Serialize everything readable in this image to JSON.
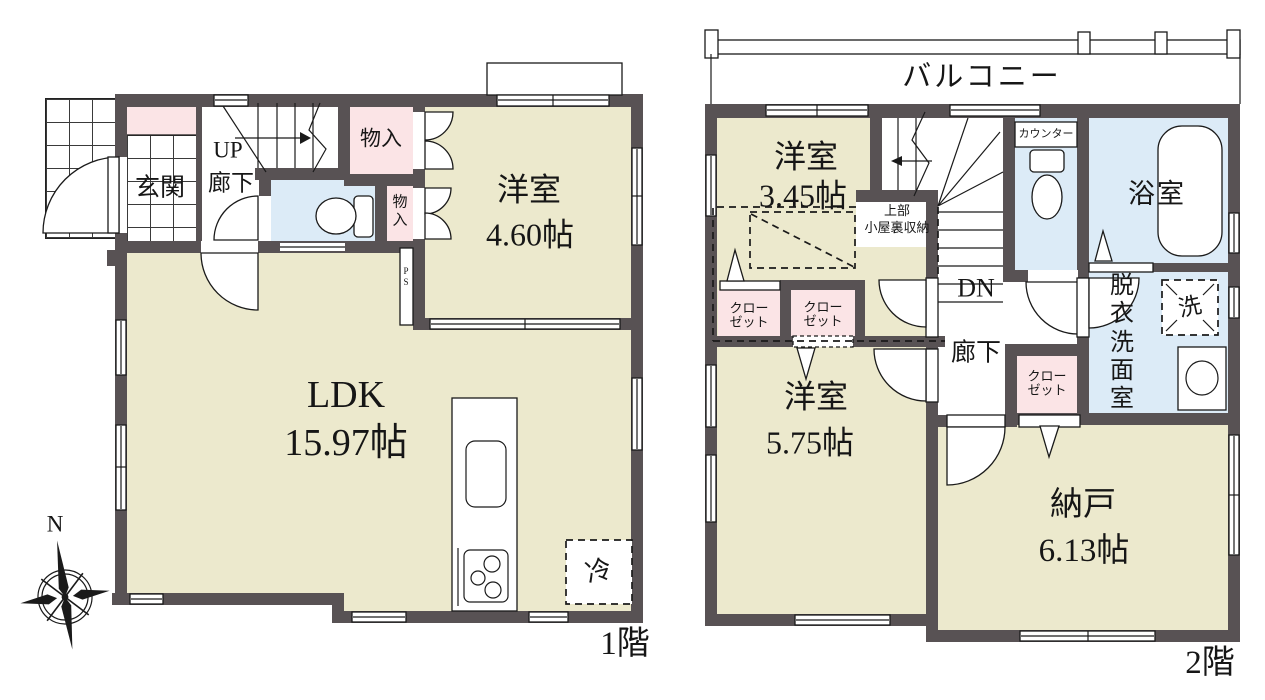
{
  "floor1": {
    "floor_label": "1階",
    "compass_north": "N",
    "entrance": "玄関",
    "stairs_up": "UP",
    "hallway": "廊下",
    "storage_upper": "物入",
    "storage_lower": "物入",
    "western_room": {
      "name": "洋室",
      "size": "4.60帖"
    },
    "ldk": {
      "name": "LDK",
      "size": "15.97帖"
    },
    "refrigerator": "冷",
    "pipe_space": "PS"
  },
  "floor2": {
    "floor_label": "2階",
    "balcony": "バルコニー",
    "western_room_small": {
      "name": "洋室",
      "size": "3.45帖"
    },
    "attic_storage": {
      "line1": "上部",
      "line2": "小屋裏収納"
    },
    "counter": "カウンター",
    "bathroom": "浴室",
    "stairs_down": "DN",
    "hallway": "廊下",
    "closet_label": "クロー\nゼット",
    "dressing_room": "脱衣洗面室",
    "washer": "洗",
    "western_room": {
      "name": "洋室",
      "size": "5.75帖"
    },
    "storage_room": {
      "name": "納戸",
      "size": "6.13帖"
    }
  },
  "colors": {
    "wall": "#585254",
    "room_floor": "#ece9cd",
    "closet_pink": "#fbe4e6",
    "wet_area_blue": "#dcebf7"
  }
}
